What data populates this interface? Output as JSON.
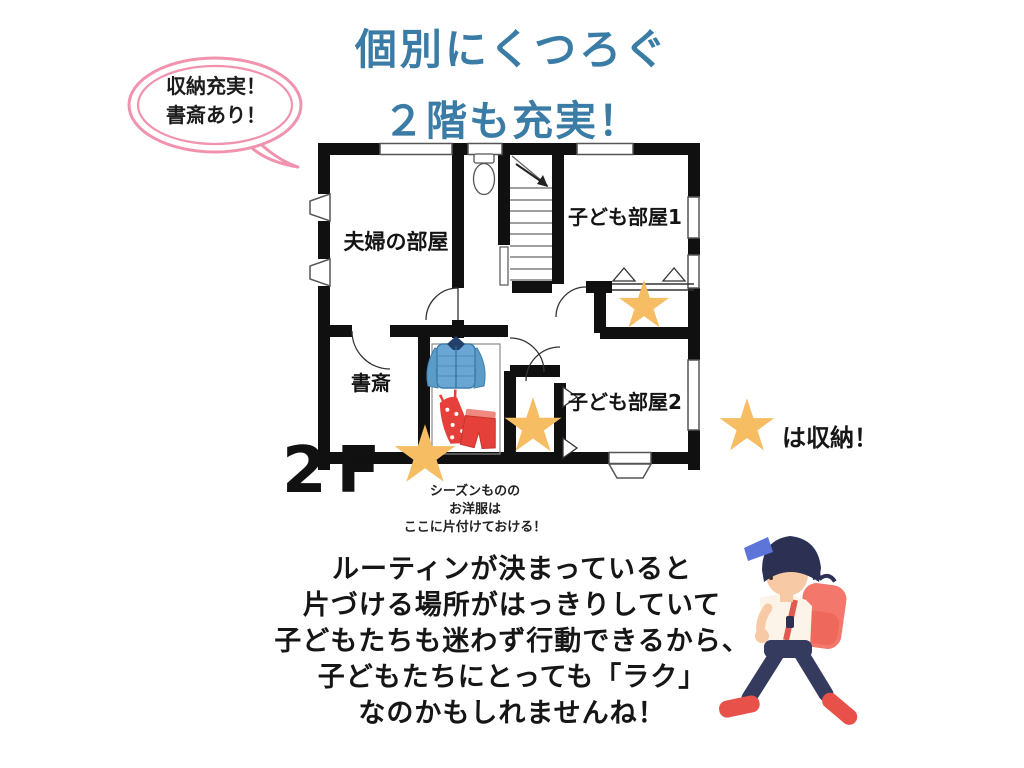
{
  "title": {
    "line1": "個別にくつろぐ",
    "line2": "２階も充実！"
  },
  "speech_bubble": {
    "line1": "収納充実！",
    "line2": "書斎あり！"
  },
  "floor_plan": {
    "floor_label": "2F",
    "rooms": {
      "couple": "夫婦の部屋",
      "kids1": "子ども部屋1",
      "study": "書斎",
      "kids2": "子ども部屋2"
    },
    "closet_caption": {
      "line1": "シーズンものの",
      "line2": "お洋服は",
      "line3": "ここに片付けておける！"
    },
    "star_count": 3
  },
  "legend": {
    "star_label": "は収納！"
  },
  "bottom_text": {
    "line1": "ルーティンが決まっていると",
    "line2": "片づける場所がはっきりしていて",
    "line3": "子どもたちも迷わず行動できるから、",
    "line4": "子どもたちにとっても「ラク」",
    "line5": "なのかもしれませんね！"
  },
  "colors": {
    "title_blue": "#3a7ca5",
    "bubble_pink": "#f192ae",
    "star_yellow": "#f6bd63",
    "wall_black": "#101010"
  }
}
